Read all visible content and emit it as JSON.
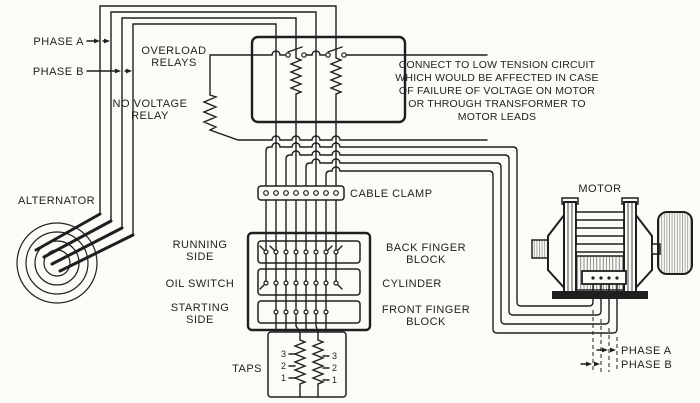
{
  "colors": {
    "ink": "#1f1f1f",
    "paper": "#fbfbf8"
  },
  "labels": {
    "phase_a_top": "PHASE A",
    "phase_b_top": "PHASE B",
    "overload_relays_1": "OVERLOAD",
    "overload_relays_2": "RELAYS",
    "no_voltage_relay_1": "NO VOLTAGE",
    "no_voltage_relay_2": "RELAY",
    "alternator": "ALTERNATOR",
    "cable_clamp": "CABLE CLAMP",
    "running_side_1": "RUNNING",
    "running_side_2": "SIDE",
    "oil_switch": "OIL SWITCH",
    "starting_side_1": "STARTING",
    "starting_side_2": "SIDE",
    "back_finger_1": "BACK FINGER",
    "back_finger_2": "BLOCK",
    "cylinder": "CYLINDER",
    "front_finger_1": "FRONT FINGER",
    "front_finger_2": "BLOCK",
    "taps": "TAPS",
    "motor": "MOTOR",
    "phase_a_bottom": "PHASE A",
    "phase_b_bottom": "PHASE B"
  },
  "note": {
    "lines": [
      "CONNECT TO LOW TENSION CIRCUIT",
      "WHICH WOULD BE AFFECTED IN CASE",
      "OF FAILURE OF VOLTAGE ON MOTOR",
      "OR THROUGH TRANSFORMER TO",
      "MOTOR LEADS"
    ]
  },
  "tap_numbers": {
    "left": [
      "3",
      "2",
      "1"
    ],
    "right": [
      "3",
      "2",
      "1"
    ]
  }
}
